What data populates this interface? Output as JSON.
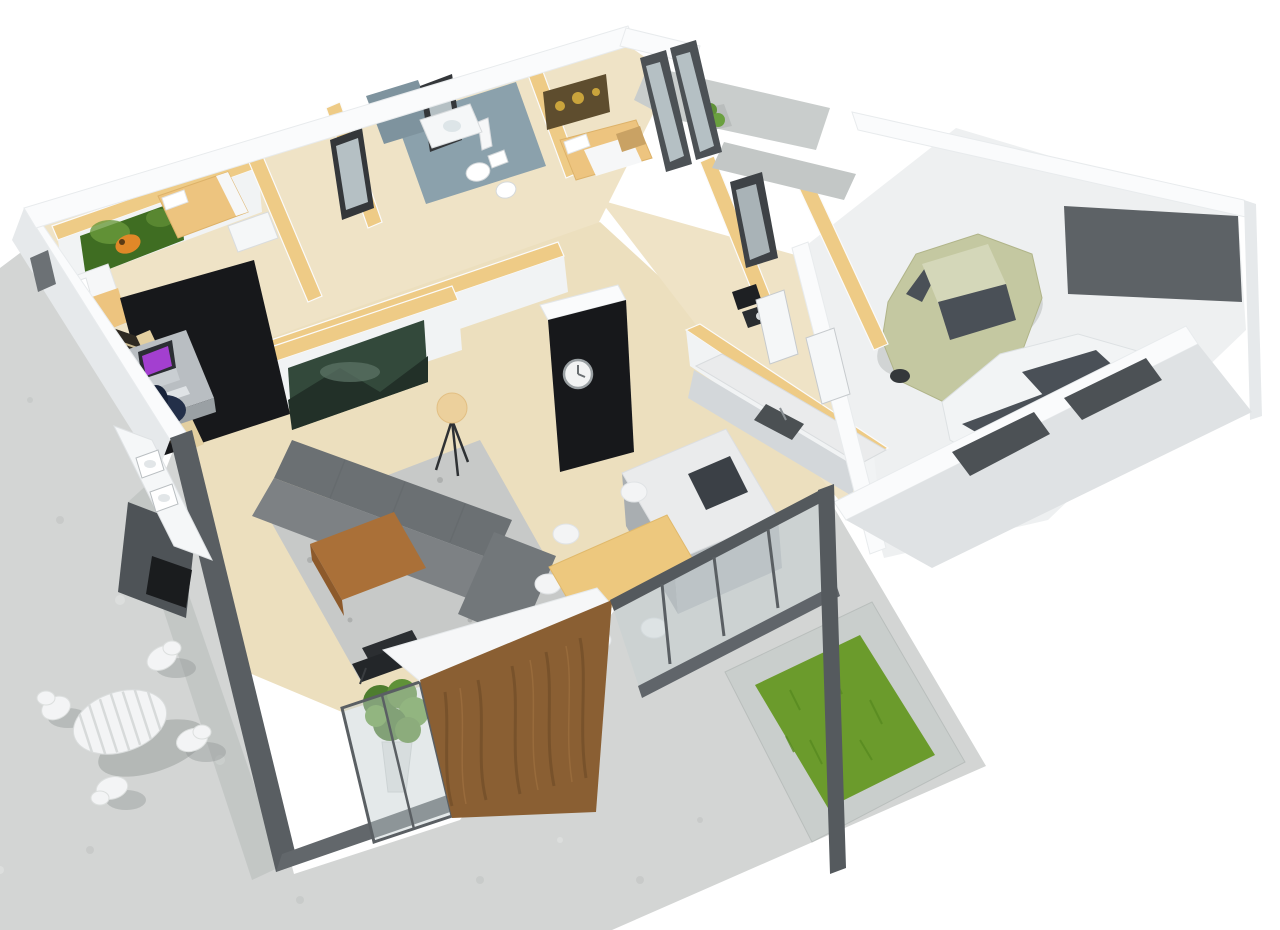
{
  "scene": {
    "title": "3D isometric floor plan rendering of a single-storey house",
    "view": "cutaway top-down perspective render, no visible text",
    "rooms": [
      {
        "name": "bedroom-1",
        "furniture": [
          "double-bed",
          "butterfly-wall-art"
        ]
      },
      {
        "name": "home-office",
        "furniture": [
          "black-accent-wall",
          "staircase",
          "desk",
          "laptop",
          "office-chair"
        ]
      },
      {
        "name": "bedroom-2",
        "furniture": [
          "double-bed",
          "dresser",
          "standing-mirror"
        ]
      },
      {
        "name": "bathroom",
        "furniture": [
          "toilet",
          "bidet",
          "vanity-sink",
          "framed-mirror",
          "tiled-floor",
          "shower"
        ]
      },
      {
        "name": "bedroom-3",
        "furniture": [
          "double-bed",
          "nightstand",
          "bottle-lamp",
          "sunflower-wall-art"
        ]
      },
      {
        "name": "living-room",
        "furniture": [
          "corner-sofa",
          "area-rug",
          "coffee-table",
          "floor-lamp",
          "landscape-wall-art",
          "lounge-chair",
          "potted-plant",
          "wall-clock-cube"
        ]
      },
      {
        "name": "kitchen",
        "furniture": [
          "wall-counter-with-sink",
          "built-in-oven",
          "kitchen-island",
          "cooktop"
        ]
      },
      {
        "name": "dining-area",
        "furniture": [
          "dining-table",
          "white-chairs",
          "glass-front-wall"
        ]
      },
      {
        "name": "entry",
        "furniture": [
          "porch-roof-slabs",
          "glass-entry-door",
          "porch-planter",
          "interior-doors"
        ]
      },
      {
        "name": "garage",
        "furniture": [
          "olive-car",
          "white-car",
          "garage-door-openings"
        ]
      },
      {
        "name": "terrace-patio",
        "furniture": [
          "round-outdoor-table",
          "outdoor-chairs",
          "privacy-wall-with-fireplace",
          "outdoor-counter",
          "wooden-slat-wall",
          "grass-planter"
        ]
      }
    ]
  },
  "palette": {
    "patio_concrete": "#d3d5d4",
    "patio_spot": "#c6c8c7",
    "patio_spot2": "#dfe1e0",
    "shadow_gray": "#8f9493",
    "planter_concrete": "#c9cecc",
    "grass_green": "#6b9b2c",
    "grass_dark": "#588а20",
    "floor_wood": "#efe3c6",
    "floor_wood2": "#ecdfbe",
    "tile_gray": "#8ba1ac",
    "tile_gray2": "#7e939e",
    "wall_white": "#fafbfc",
    "wall_face": "#f1f3f4",
    "wall_shade": "#e6e9eb",
    "tan_wall": "#eecb86",
    "anthracite": "#595e62",
    "anthracite2": "#62676b",
    "black_wall": "#17181b",
    "wood_panel": "#8a5f33",
    "wood_panel_dark": "#74502a",
    "glass_tint": "rgba(196,206,208,0.45)",
    "frame_dark": "#4c5155",
    "sofa_gray": "#7d8184",
    "sofa_dark": "#6b7073",
    "sofa_mid": "#72777a",
    "rug_gray": "#c7c9c8",
    "rug_dot": "#aeb0af",
    "table_brown": "#aa7038",
    "table_brown_dark": "#8d5a2b",
    "dining_wood": "#edc87e",
    "chair_white": "#f3f4f5",
    "marble": "#eaebec",
    "counter_face": "#d3d7da",
    "island_face": "#a9aeb1",
    "cooktop_dark": "#3b4046",
    "sink_dark": "#4b5053",
    "bed_tan": "#edc47f",
    "sheet_white": "#f6f7f8",
    "stair_dark": "#2f2a22",
    "stair_side": "#e3cfa0",
    "stair_tread": "#c9b98f",
    "desk_gray": "#b9bec2",
    "desk_face": "#9aa0a4",
    "laptop_purple": "#a33fd0",
    "laptop_body": "#c9ced2",
    "chair_navy": "#232f49",
    "pic_green": "#3f6d22",
    "pic_green2": "#6a9a3c",
    "pic_forest": "#33493b",
    "pic_forest2": "#223028",
    "pic_sunflower": "#5e4d2e",
    "sunflower_yellow": "#caa43c",
    "butterfly_orange": "#e08828",
    "car_olive": "#c4c8a1",
    "car_olive_roof": "#d4d7b9",
    "car_white": "#f2f4f5",
    "car_window": "#4a5057",
    "wheel_dark": "#34383b",
    "garage_floor": "#eef0f1",
    "garage_dark_band": "#5d6266",
    "porch_slab": "#c9cdcc",
    "plant_green": "#4e7d2f",
    "plant_green2": "#5f9138",
    "plant_green3": "#6aa03f",
    "lamp_shade": "#ecd09c",
    "mirror_glass": "#b5c0c4",
    "door_white": "#f5f7f8",
    "fixture_white": "#ffffff",
    "clock_face": "#f2f3f3"
  }
}
